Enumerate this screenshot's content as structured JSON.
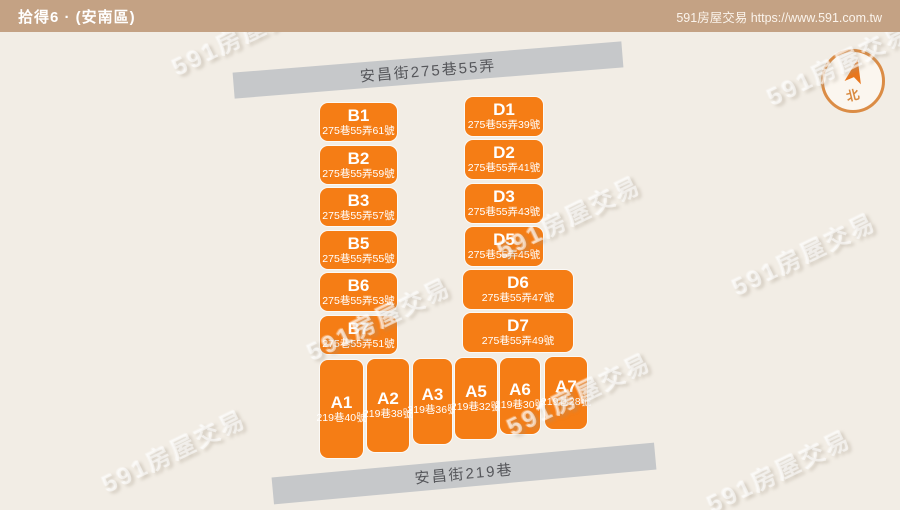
{
  "header": {
    "title": "拾得6 · (安南區)",
    "site_credit": "591房屋交易 https://www.591.com.tw"
  },
  "map": {
    "watermark_text": "591房屋交易",
    "roads": {
      "top": "安昌街275巷55弄",
      "bottom": "安昌街219巷"
    },
    "compass": {
      "north_label": "北"
    },
    "colors": {
      "header_bg": "#C4A284",
      "map_bg": "#F2EDE5",
      "block_orange": "#F57D15",
      "road_gray": "#C6C8CA",
      "road_text": "#55565A",
      "compass_ring": "#DB8C45",
      "compass_arrow": "#E8771E"
    },
    "blocks": {
      "b_column": [
        {
          "id": "B1",
          "address": "275巷55弄61號"
        },
        {
          "id": "B2",
          "address": "275巷55弄59號"
        },
        {
          "id": "B3",
          "address": "275巷55弄57號"
        },
        {
          "id": "B5",
          "address": "275巷55弄55號"
        },
        {
          "id": "B6",
          "address": "275巷55弄53號"
        },
        {
          "id": "B7",
          "address": "275巷55弄51號"
        }
      ],
      "d_column": [
        {
          "id": "D1",
          "address": "275巷55弄39號"
        },
        {
          "id": "D2",
          "address": "275巷55弄41號"
        },
        {
          "id": "D3",
          "address": "275巷55弄43號"
        },
        {
          "id": "D5",
          "address": "275巷55弄45號"
        },
        {
          "id": "D6",
          "address": "275巷55弄47號"
        },
        {
          "id": "D7",
          "address": "275巷55弄49號"
        }
      ],
      "a_row": [
        {
          "id": "A1",
          "address": "219巷40號"
        },
        {
          "id": "A2",
          "address": "219巷38號"
        },
        {
          "id": "A3",
          "address": "219巷36號"
        },
        {
          "id": "A5",
          "address": "219巷32號"
        },
        {
          "id": "A6",
          "address": "219巷30號"
        },
        {
          "id": "A7",
          "address": "219巷28號"
        }
      ]
    }
  }
}
